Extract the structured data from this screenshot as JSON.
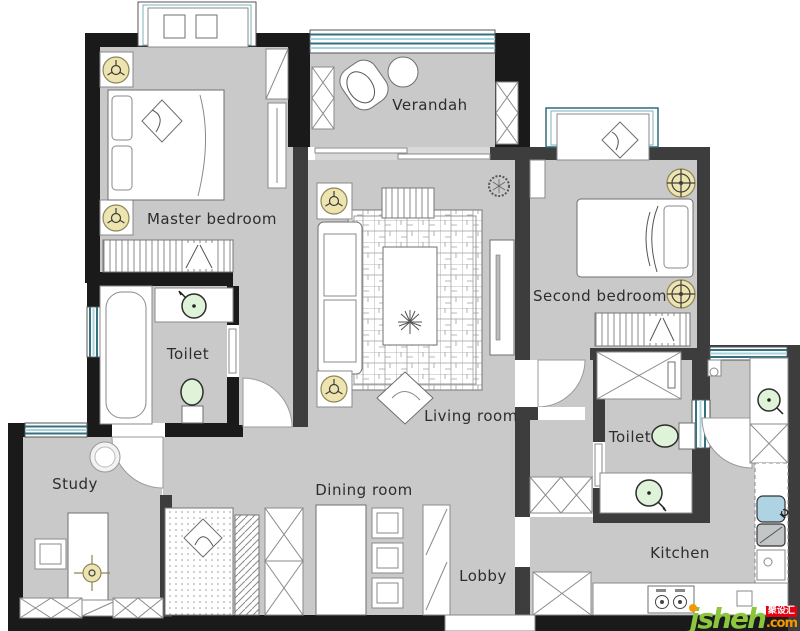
{
  "rooms": {
    "master_bedroom": {
      "label": "Master bedroom"
    },
    "verandah": {
      "label": "Verandah"
    },
    "second_bedroom": {
      "label": "Second bedroom"
    },
    "toilet_left": {
      "label": "Toilet"
    },
    "living_room": {
      "label": "Living room"
    },
    "study": {
      "label": "Study"
    },
    "dining_room": {
      "label": "Dining room"
    },
    "lobby": {
      "label": "Lobby"
    },
    "toilet_right": {
      "label": "Toilet"
    },
    "kitchen": {
      "label": "Kitchen"
    }
  },
  "watermark": {
    "brand": "jsheh",
    "tld": ".com",
    "badge": "聚设汇"
  },
  "icons": {
    "ceiling_speaker": "yellow circle with trefoil glyph",
    "ceiling_lamp": "yellow circle with crosshair glyph",
    "fan_lamp": "gold crosshair target",
    "sink": "green circle with faucet tick",
    "toilet_bowl": "green oval with cistern",
    "kitchen_sink": "blue rounded square",
    "plant": "dark scribble circle"
  },
  "colors": {
    "wall_black": "#1a1a1a",
    "wall_gray": "#3d3d3d",
    "floor": "#c9c9c9",
    "window_teal": "#35707e",
    "window_light": "#a8d4de",
    "fixture_green": "#dff3d8",
    "icon_yellow": "#eee4b0",
    "sink_blue": "#aed3e3",
    "brand_green": "#8cc63f",
    "brand_orange": "#f39800",
    "badge_red": "#e60012",
    "label_text": "#2d2d2d"
  }
}
